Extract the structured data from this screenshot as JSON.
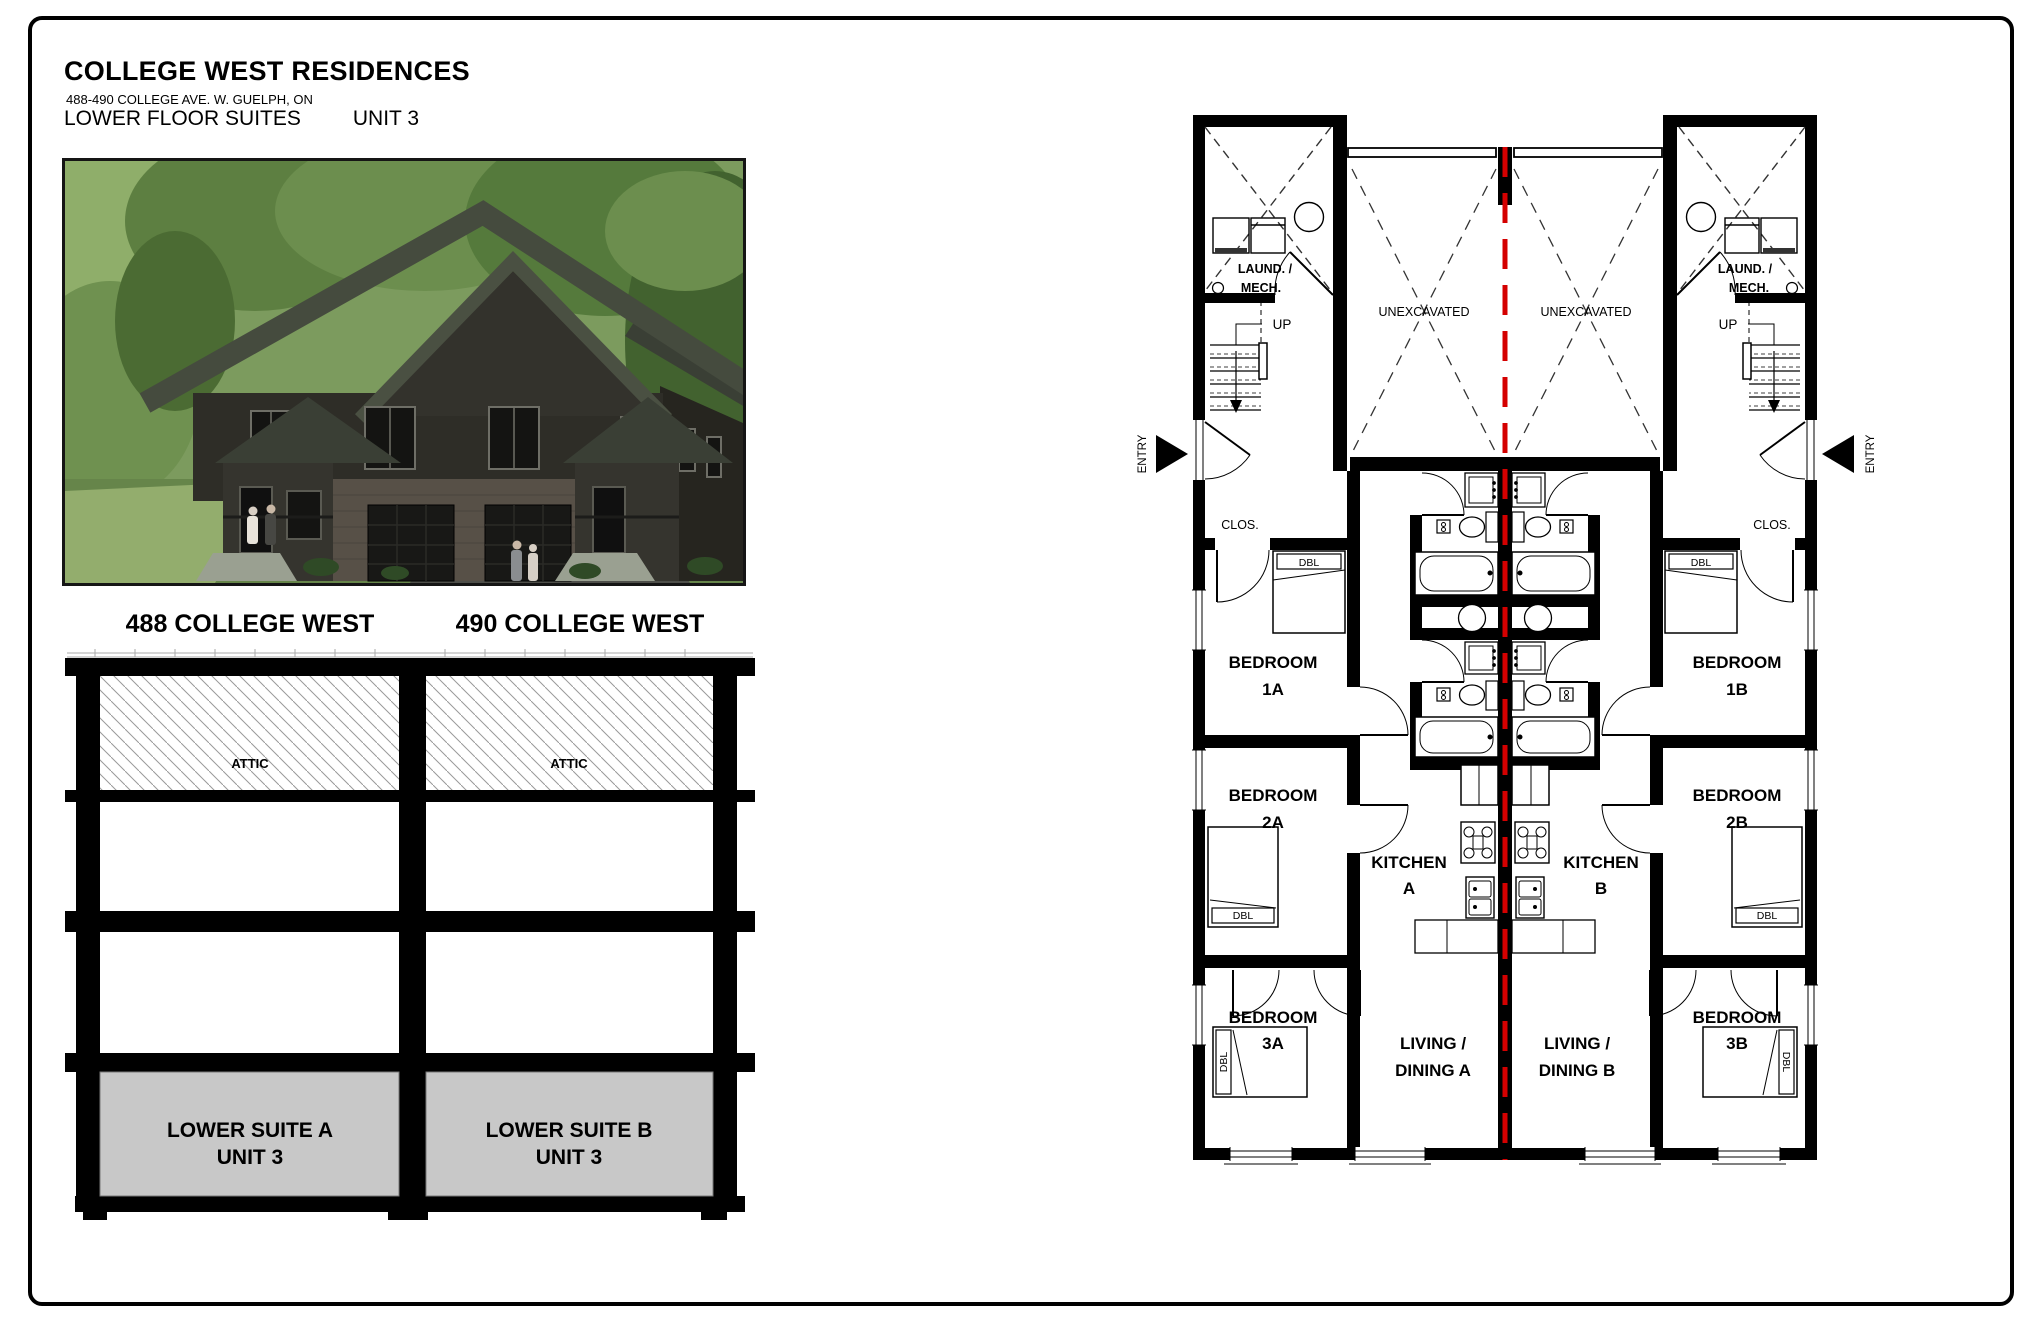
{
  "header": {
    "title": "COLLEGE WEST RESIDENCES",
    "address": "488-490 COLLEGE AVE. W. GUELPH, ON",
    "subtitle": "LOWER FLOOR SUITES",
    "unit": "UNIT 3"
  },
  "photo": {
    "caption_left": "488 COLLEGE WEST",
    "caption_right": "490 COLLEGE WEST"
  },
  "section": {
    "attic_a": "ATTIC",
    "attic_b": "ATTIC",
    "suite_a_line1": "LOWER SUITE A",
    "suite_a_line2": "UNIT 3",
    "suite_b_line1": "LOWER SUITE B",
    "suite_b_line2": "UNIT 3",
    "suite_fill": "#c8c8c8"
  },
  "plan": {
    "demising_color": "#d40000",
    "suite_a": {
      "laund1": "LAUND. /",
      "laund2": "MECH.",
      "up": "UP",
      "entry": "ENTRY",
      "unexcavated": "UNEXCAVATED",
      "clos": "CLOS.",
      "bed1_1": "BEDROOM",
      "bed1_2": "1A",
      "bed2_1": "BEDROOM",
      "bed2_2": "2A",
      "bed3_1": "BEDROOM",
      "bed3_2": "3A",
      "kitchen1": "KITCHEN",
      "kitchen2": "A",
      "living1": "LIVING /",
      "living2": "DINING A",
      "dbl1": "DBL",
      "dbl2": "DBL",
      "dbl3": "DBL"
    },
    "suite_b": {
      "laund1": "LAUND. /",
      "laund2": "MECH.",
      "up": "UP",
      "entry": "ENTRY",
      "unexcavated": "UNEXCAVATED",
      "clos": "CLOS.",
      "bed1_1": "BEDROOM",
      "bed1_2": "1B",
      "bed2_1": "BEDROOM",
      "bed2_2": "2B",
      "bed3_1": "BEDROOM",
      "bed3_2": "3B",
      "kitchen1": "KITCHEN",
      "kitchen2": "B",
      "living1": "LIVING /",
      "living2": "DINING B",
      "dbl1": "DBL",
      "dbl2": "DBL",
      "dbl3": "DBL"
    }
  }
}
